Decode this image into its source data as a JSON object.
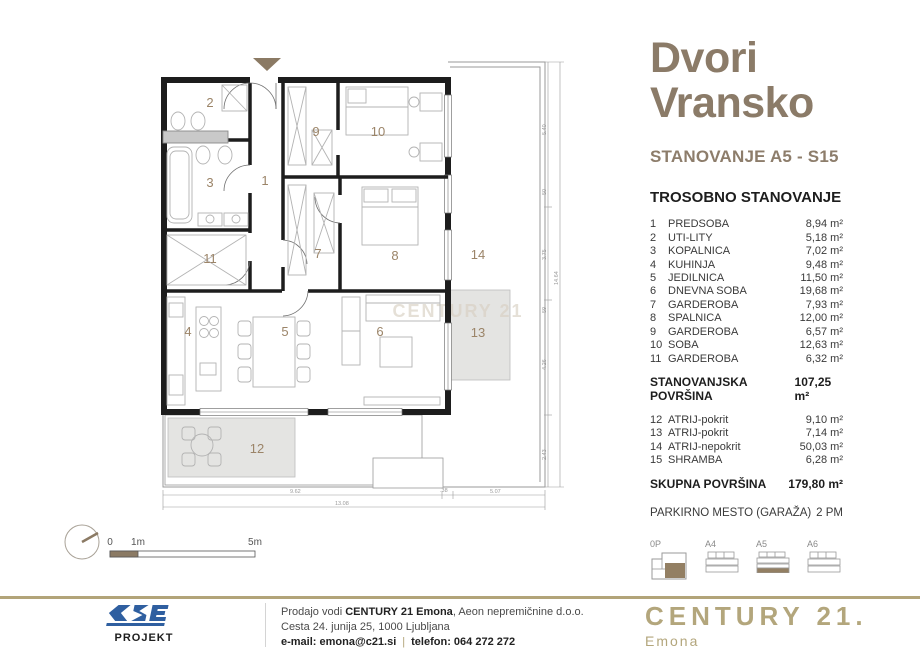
{
  "header": {
    "title_line1": "Dvori",
    "title_line2": "Vransko",
    "subtitle": "STANOVANJE A5 - S15",
    "apartment_type": "TROSOBNO STANOVANJE"
  },
  "list": {
    "rooms": [
      {
        "n": "1",
        "name": "PREDSOBA",
        "area": "8,94 m²"
      },
      {
        "n": "2",
        "name": "UTI-LITY",
        "area": "5,18 m²"
      },
      {
        "n": "3",
        "name": "KOPALNICA",
        "area": "7,02 m²"
      },
      {
        "n": "4",
        "name": "KUHINJA",
        "area": "9,48 m²"
      },
      {
        "n": "5",
        "name": "JEDILNICA",
        "area": "11,50 m²"
      },
      {
        "n": "6",
        "name": "DNEVNA SOBA",
        "area": "19,68 m²"
      },
      {
        "n": "7",
        "name": "GARDEROBA",
        "area": "7,93 m²"
      },
      {
        "n": "8",
        "name": "SPALNICA",
        "area": "12,00 m²"
      },
      {
        "n": "9",
        "name": "GARDEROBA",
        "area": "6,57 m²"
      },
      {
        "n": "10",
        "name": "SOBA",
        "area": "12,63 m²"
      },
      {
        "n": "11",
        "name": "GARDEROBA",
        "area": "6,32 m²"
      }
    ],
    "subtotal": {
      "label": "STANOVANJSKA POVRŠINA",
      "value": "107,25 m²"
    },
    "extras": [
      {
        "n": "12",
        "name": "ATRIJ-pokrit",
        "area": "9,10 m²"
      },
      {
        "n": "13",
        "name": "ATRIJ-pokrit",
        "area": "7,14 m²"
      },
      {
        "n": "14",
        "name": "ATRIJ-nepokrit",
        "area": "50,03 m²"
      },
      {
        "n": "15",
        "name": "SHRAMBA",
        "area": "6,28 m²"
      }
    ],
    "total": {
      "label": "SKUPNA POVRŠINA",
      "value": "179,80 m²"
    },
    "parking": {
      "label": "PARKIRNO MESTO (GARAŽA)",
      "value": "2 PM"
    }
  },
  "plan": {
    "watermark": "CENTURY 21",
    "room_numbers": {
      "r1": "1",
      "r2": "2",
      "r3": "3",
      "r4": "4",
      "r5": "5",
      "r6": "6",
      "r7": "7",
      "r8": "8",
      "r9": "9",
      "r10": "10",
      "r11": "11",
      "r12": "12",
      "r13": "13",
      "r14": "14"
    },
    "dims": {
      "right_total": "14.64",
      "right_segments": [
        "5.40",
        "50",
        "3.75",
        "59",
        "4.26",
        "2.43"
      ],
      "bottom_segments": [
        "9.62",
        ".38",
        "5.07"
      ],
      "bottom_total": "13.08"
    },
    "scale_bar": {
      "zero": "0",
      "one": "1m",
      "five": "5m"
    }
  },
  "mini_plans": {
    "items": [
      {
        "label": "0P"
      },
      {
        "label": "A4"
      },
      {
        "label": "A5"
      },
      {
        "label": "A6"
      }
    ],
    "highlight_color": "#937f63"
  },
  "footer": {
    "line1_prefix": "Prodajo vodi ",
    "line1_bold": "CENTURY 21 Emona",
    "line1_suffix": ", Aeon nepremičnine d.o.o.",
    "line2": "Cesta 24.  junija 25, 1000 Ljubljana",
    "email_label": "e-mail: ",
    "email": "emona@c21.si",
    "separator": "|",
    "phone_label": "telefon: ",
    "phone": "064 272 272",
    "cse_logo_text": "CSE",
    "cse_logo_sub": "PROJEKT",
    "c21_logo_text": "CENTURY 21.",
    "c21_logo_sub": "Emona"
  },
  "colors": {
    "accent_taupe": "#8b7a64",
    "gold": "#b2a479",
    "cse_blue": "#2f5fa0",
    "wall": "#1d1d1d",
    "shade_gray": "#e4e4e2"
  }
}
